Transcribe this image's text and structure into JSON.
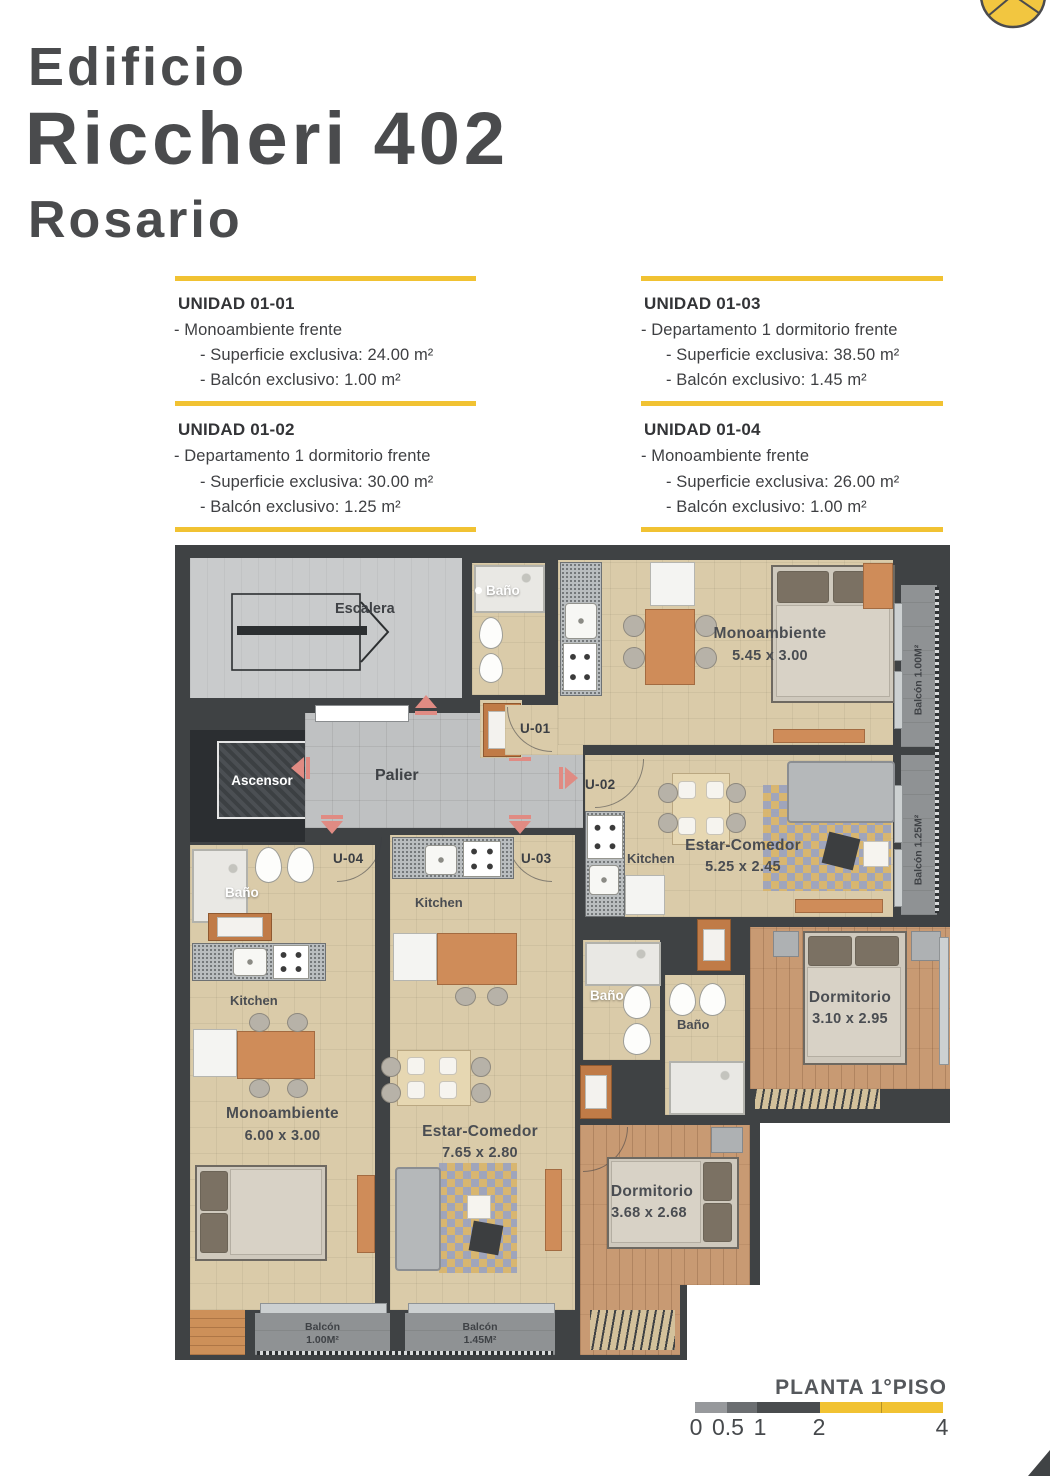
{
  "header": {
    "building": "Edificio",
    "name": "Riccheri 402",
    "city": "Rosario"
  },
  "units": [
    {
      "label": "UNIDAD 01-01",
      "type": "- Monoambiente frente",
      "surface": "- Superficie exclusiva: 24.00 m²",
      "balcony": "- Balcón exclusivo: 1.00 m²"
    },
    {
      "label": "UNIDAD 01-02",
      "type": "- Departamento 1 dormitorio frente",
      "surface": "- Superficie exclusiva: 30.00 m²",
      "balcony": "- Balcón exclusivo: 1.25 m²"
    },
    {
      "label": "UNIDAD 01-03",
      "type": "- Departamento 1 dormitorio frente",
      "surface": "- Superficie exclusiva: 38.50 m²",
      "balcony": "- Balcón exclusivo: 1.45 m²"
    },
    {
      "label": "UNIDAD 01-04",
      "type": "- Monoambiente frente",
      "surface": "- Superficie exclusiva: 26.00 m²",
      "balcony": "- Balcón exclusivo: 1.00 m²"
    }
  ],
  "plan": {
    "escalera_label": "Escalera",
    "ascensor_label": "Ascensor",
    "palier_label": "Palier",
    "bano_label": "Baño",
    "kitchen_label": "Kitchen",
    "doors": {
      "u01": "U-01",
      "u02": "U-02",
      "u03": "U-03",
      "u04": "U-04"
    },
    "rooms": [
      {
        "name": "Monoambiente",
        "dims": "5.45 x 3.00"
      },
      {
        "name": "Estar-Comedor",
        "dims": "5.25 x 2.45"
      },
      {
        "name": "Dormitorio",
        "dims": "3.10 x 2.95"
      },
      {
        "name": "Monoambiente",
        "dims": "6.00 x 3.00"
      },
      {
        "name": "Estar-Comedor",
        "dims": "7.65 x 2.80"
      },
      {
        "name": "Dormitorio",
        "dims": "3.68 x 2.68"
      }
    ],
    "balconies": {
      "right_top": "Balcón 1.00M²",
      "right_bottom": "Balcón 1.25M²",
      "bottom_left_1": "Balcón",
      "bottom_left_2": "1.00M²",
      "bottom_mid_1": "Balcón",
      "bottom_mid_2": "1.45M²"
    }
  },
  "footer": {
    "title": "PLANTA 1°PISO",
    "ticks": [
      "0",
      "0.5",
      "1",
      "2",
      "4"
    ]
  },
  "colors": {
    "accent": "#f1c232",
    "wall": "#3f4244",
    "text_dark": "#4a4b4d"
  }
}
